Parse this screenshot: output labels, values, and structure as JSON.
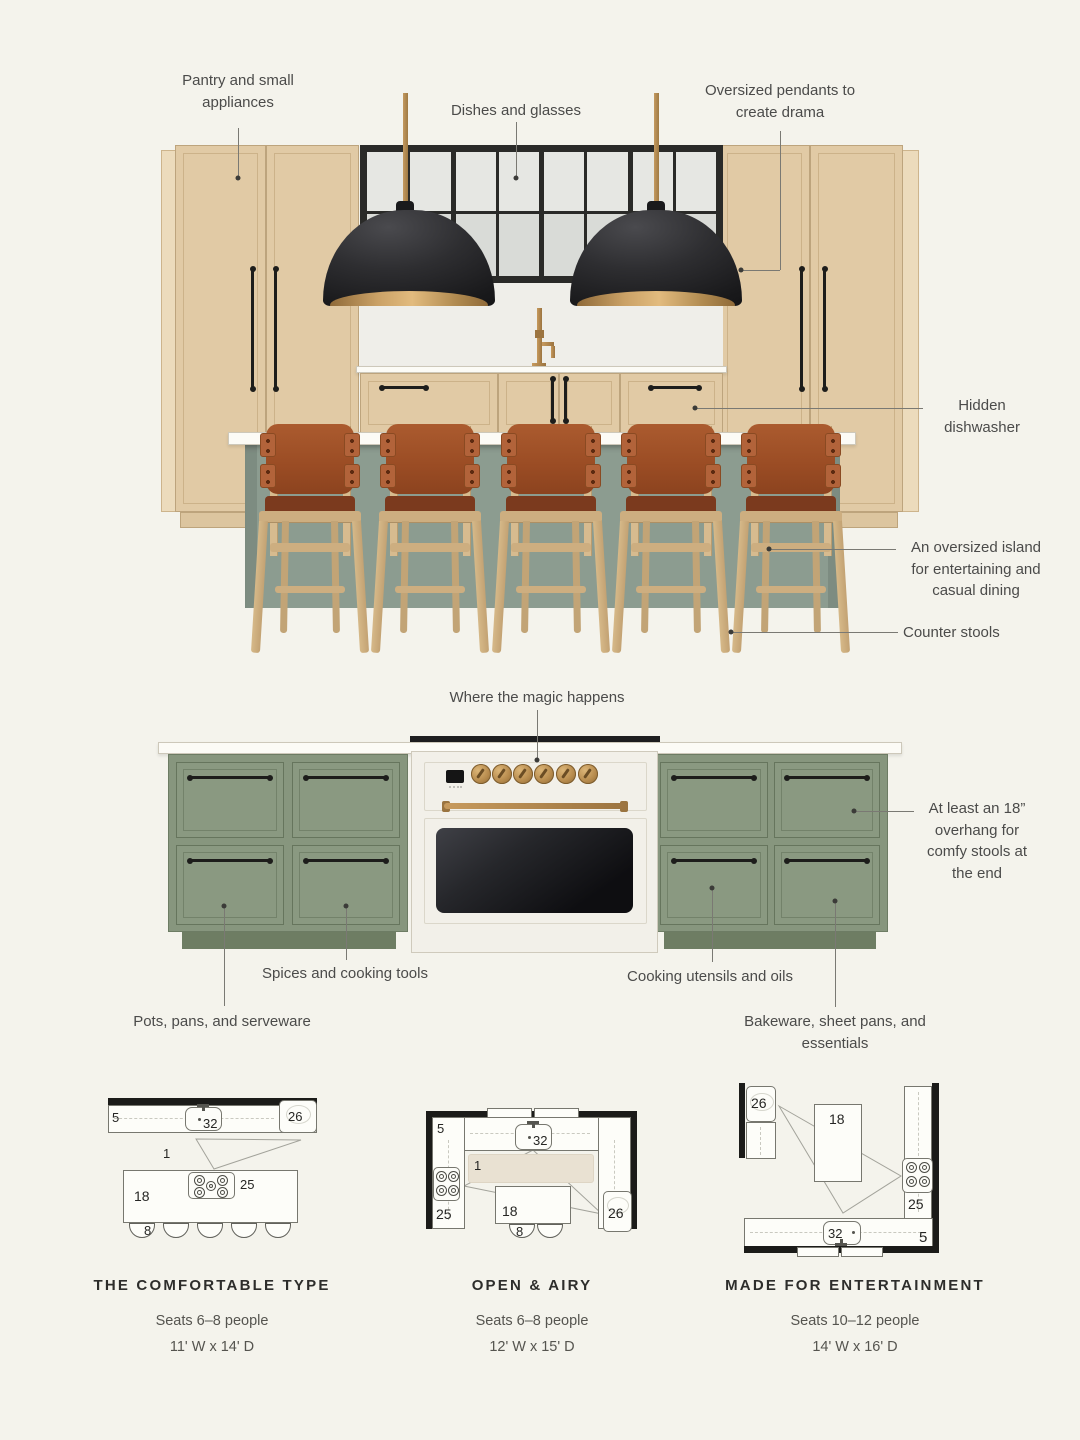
{
  "top": {
    "labels": {
      "pantry": "Pantry and small appliances",
      "dishes": "Dishes and glasses",
      "pendants": "Oversized pendants to create drama",
      "dishwasher": "Hidden dishwasher",
      "island": "An oversized island for entertaining and casual dining",
      "stools": "Counter stools"
    }
  },
  "middle": {
    "labels": {
      "magic": "Where the magic happens",
      "overhang": "At least an 18” overhang for comfy stools at the end",
      "spices": "Spices and cooking tools",
      "pots": "Pots, pans, and serveware",
      "utensils": "Cooking utensils and oils",
      "bakeware": "Bakeware, sheet pans, and essentials"
    }
  },
  "plans": [
    {
      "title": "THE COMFORTABLE TYPE",
      "seats": "Seats 6–8 people",
      "size": "11' W x 14' D",
      "labels": {
        "counter": "5",
        "oven": "26",
        "sink": "32",
        "zone": "1",
        "island": "18",
        "cooktop": "25",
        "stool": "8"
      }
    },
    {
      "title": "OPEN & AIRY",
      "seats": "Seats 6–8 people",
      "size": "12' W x 15' D",
      "labels": {
        "counter": "5",
        "oven": "26",
        "sink": "32",
        "zone": "1",
        "island": "18",
        "cooktop": "25",
        "stool": "8"
      }
    },
    {
      "title": "MADE FOR ENTERTAINMENT",
      "seats": "Seats 10–12 people",
      "size": "14' W x 16' D",
      "labels": {
        "counter": "5",
        "oven": "26",
        "sink": "32",
        "island": "18",
        "cooktop": "25"
      }
    }
  ],
  "colors": {
    "background": "#f4f3ec",
    "cabinet_tan": "#e1caa5",
    "cabinet_green": "#87967e",
    "island_sage": "#8c9c90",
    "pendant_black": "#1a1a1c",
    "brass": "#b68d54",
    "leather": "#a5562c",
    "wood": "#d3b78b",
    "wall_black": "#1b1b19"
  }
}
